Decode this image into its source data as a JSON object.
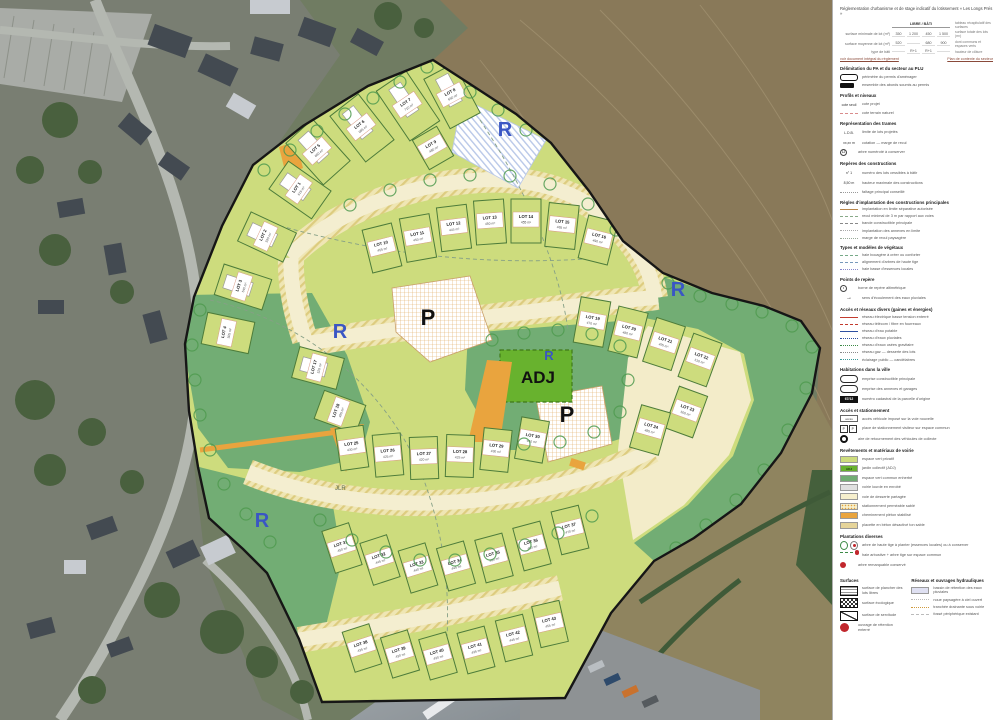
{
  "plan": {
    "labels": {
      "adj": "ADJ",
      "reserve": "R",
      "parking": "P",
      "watermark": "JLR"
    },
    "colors": {
      "lot_green": "#cddc7d",
      "lot_stroke": "#4d7c3a",
      "common_green": "#72ad74",
      "adj_green": "#68b22e",
      "road_cream": "#f4eed0",
      "road_hatch": "#e6d98f",
      "orange": "#e9a43e",
      "boundary": "#161616",
      "reserve_blue": "#3a56c4",
      "parking_grid": "#dfa95f",
      "blue_hatch": "#9db4e0"
    },
    "markers": [
      {
        "t": "R",
        "x": 505,
        "y": 136,
        "s": 20
      },
      {
        "t": "R",
        "x": 678,
        "y": 296,
        "s": 20
      },
      {
        "t": "R",
        "x": 340,
        "y": 338,
        "s": 20
      },
      {
        "t": "R",
        "x": 549,
        "y": 360,
        "s": 13
      },
      {
        "t": "R",
        "x": 262,
        "y": 527,
        "s": 20
      },
      {
        "t": "P",
        "x": 428,
        "y": 325,
        "s": 22
      },
      {
        "t": "P",
        "x": 567,
        "y": 422,
        "s": 22
      },
      {
        "t": "ADJ",
        "x": 538,
        "y": 383,
        "s": 17
      }
    ],
    "lots": [
      [
        300,
        190,
        -55,
        34,
        52,
        "LOT 1",
        "615 m²",
        1
      ],
      [
        267,
        237,
        -65,
        32,
        50,
        "LOT 2",
        "590 m²",
        1
      ],
      [
        243,
        287,
        -72,
        32,
        50,
        "LOT 3",
        "540 m²",
        1
      ],
      [
        228,
        333,
        -78,
        32,
        48,
        "LOT 4",
        "505 m²",
        0
      ],
      [
        318,
        152,
        -42,
        36,
        56,
        "LOT 5",
        "660 m²",
        1
      ],
      [
        362,
        128,
        -38,
        36,
        58,
        "LOT 6",
        "685 m²",
        1
      ],
      [
        408,
        106,
        -34,
        36,
        60,
        "LOT 7",
        "710 m²",
        1
      ],
      [
        452,
        96,
        -28,
        34,
        56,
        "LOT 8",
        "650 m²",
        1
      ],
      [
        433,
        148,
        -30,
        28,
        34,
        "LOT 9",
        "480 m²",
        0
      ],
      [
        382,
        248,
        -14,
        30,
        44,
        "LOT 10",
        "455 m²",
        0
      ],
      [
        418,
        238,
        -10,
        30,
        44,
        "LOT 11",
        "450 m²",
        0
      ],
      [
        454,
        228,
        -7,
        30,
        44,
        "LOT 12",
        "445 m²",
        0
      ],
      [
        490,
        222,
        -4,
        30,
        44,
        "LOT 13",
        "450 m²",
        0
      ],
      [
        526,
        221,
        0,
        30,
        44,
        "LOT 14",
        "455 m²",
        0
      ],
      [
        562,
        226,
        6,
        30,
        44,
        "LOT 15",
        "465 m²",
        0
      ],
      [
        598,
        240,
        14,
        30,
        44,
        "LOT 16",
        "490 m²",
        0
      ],
      [
        318,
        368,
        -75,
        32,
        46,
        "LOT 17",
        "520 m²",
        1
      ],
      [
        340,
        412,
        -70,
        30,
        44,
        "LOT 18",
        "495 m²",
        0
      ],
      [
        592,
        322,
        10,
        30,
        46,
        "LOT 19",
        "470 m²",
        0
      ],
      [
        628,
        332,
        14,
        30,
        46,
        "LOT 20",
        "480 m²",
        0
      ],
      [
        664,
        344,
        18,
        30,
        46,
        "LOT 21",
        "495 m²",
        0
      ],
      [
        700,
        360,
        20,
        30,
        46,
        "LOT 22",
        "510 m²",
        0
      ],
      [
        686,
        412,
        20,
        30,
        44,
        "LOT 23",
        "500 m²",
        0
      ],
      [
        650,
        430,
        16,
        30,
        44,
        "LOT 24",
        "485 m²",
        0
      ],
      [
        352,
        448,
        -8,
        28,
        42,
        "LOT 25",
        "430 m²",
        0
      ],
      [
        388,
        455,
        -5,
        28,
        42,
        "LOT 26",
        "425 m²",
        0
      ],
      [
        424,
        458,
        -2,
        28,
        42,
        "LOT 27",
        "420 m²",
        0
      ],
      [
        460,
        456,
        2,
        28,
        42,
        "LOT 28",
        "425 m²",
        0
      ],
      [
        496,
        450,
        6,
        28,
        42,
        "LOT 29",
        "430 m²",
        0
      ],
      [
        532,
        440,
        10,
        28,
        42,
        "LOT 30",
        "440 m²",
        0
      ],
      [
        342,
        548,
        -18,
        28,
        44,
        "LOT 31",
        "450 m²",
        0
      ],
      [
        380,
        560,
        -18,
        28,
        44,
        "LOT 32",
        "445 m²",
        0
      ],
      [
        418,
        568,
        -17,
        28,
        44,
        "LOT 33",
        "440 m²",
        0
      ],
      [
        456,
        566,
        -16,
        28,
        44,
        "LOT 34",
        "445 m²",
        0
      ],
      [
        494,
        558,
        -15,
        28,
        44,
        "LOT 35",
        "450 m²",
        0
      ],
      [
        532,
        546,
        -15,
        28,
        44,
        "LOT 36",
        "460 m²",
        0
      ],
      [
        570,
        530,
        -14,
        28,
        44,
        "LOT 37",
        "470 m²",
        0
      ],
      [
        362,
        648,
        -18,
        28,
        42,
        "LOT 38",
        "435 m²",
        0
      ],
      [
        400,
        654,
        -17,
        28,
        42,
        "LOT 39",
        "430 m²",
        0
      ],
      [
        438,
        656,
        -16,
        28,
        42,
        "LOT 40",
        "430 m²",
        0
      ],
      [
        476,
        650,
        -15,
        28,
        42,
        "LOT 41",
        "435 m²",
        0
      ],
      [
        514,
        638,
        -14,
        28,
        42,
        "LOT 42",
        "445 m²",
        0
      ],
      [
        550,
        624,
        -13,
        28,
        42,
        "LOT 43",
        "455 m²",
        0
      ]
    ]
  },
  "legend": {
    "title": "Réglementation d'urbanisme et de stage indicatif du lotissement « Les Longs Prés »",
    "table": {
      "group_header": "LIBRE / BÂTI",
      "right_header": "tableau récapitulatif des surfaces",
      "rows": [
        {
          "left": "surface minimale de lot (m²)",
          "values": [
            "350",
            "1 200",
            "450",
            "1 500"
          ],
          "right": "surface totale des lots (m²)"
        },
        {
          "left": "surface moyenne de lot (m²)",
          "values": [
            "520",
            "",
            "680",
            "900"
          ],
          "right": "dont communs et espaces verts"
        },
        {
          "left": "type de bâti",
          "values": [
            "",
            "R+1",
            "R+1",
            ""
          ],
          "right": "hauteur de clôture"
        }
      ]
    },
    "links": [
      "voir document intégral du règlement",
      "Plan de contexte du secteur"
    ],
    "sections": [
      {
        "heading": "Délimitation du PA et du secteur au PLU",
        "items": [
          {
            "icon": "rounded-outline",
            "label": "périmètre du permis d'aménager"
          },
          {
            "icon": "filled-tag",
            "label": "ensemble des abords soumis au permis"
          }
        ]
      },
      {
        "heading": "Profils et niveaux",
        "items": [
          {
            "icon": "text-code",
            "code": "cote seuil",
            "label": "cote projet"
          },
          {
            "icon": "line",
            "color": "#d98c8c",
            "style": "dashed",
            "label": "cote terrain naturel"
          }
        ]
      },
      {
        "heading": "Représentation des trames",
        "items": [
          {
            "icon": "text-code",
            "code": "L.D.B.",
            "label": "limite de lots projetés"
          },
          {
            "icon": "text-code",
            "code": "xx,xx m",
            "label": "cotation — marge de recul"
          },
          {
            "icon": "circled",
            "code": "12",
            "label": "arbre numéroté à conserver"
          }
        ]
      },
      {
        "heading": "Repères des constructions",
        "items": [
          {
            "icon": "text-code",
            "code": "n° 1",
            "label": "numéro des lots cessibles à bâtir"
          },
          {
            "icon": "text-code",
            "code": "8,50 m",
            "label": "hauteur maximale des constructions"
          },
          {
            "icon": "line",
            "color": "#999999",
            "style": "dotted",
            "label": "faîtage principal conseillé"
          }
        ]
      },
      {
        "heading": "Règles d'implantation des constructions principales",
        "items": [
          {
            "icon": "line",
            "color": "#b8864a",
            "style": "solid",
            "label": "implantation en limite séparative autorisée"
          },
          {
            "icon": "line",
            "color": "#88aa88",
            "style": "dashed",
            "label": "recul minimal de 3 m par rapport aux voies"
          },
          {
            "icon": "line",
            "color": "#888888",
            "style": "dashed",
            "label": "bande constructible principale"
          },
          {
            "icon": "line",
            "color": "#aaaaaa",
            "style": "dotted",
            "label": "implantation des annexes en limite"
          },
          {
            "icon": "line",
            "color": "#99aa99",
            "style": "dotted",
            "label": "marge de recul paysagère"
          }
        ]
      },
      {
        "heading": "Types et modèles de végétaux",
        "items": [
          {
            "icon": "line",
            "color": "#77aa88",
            "style": "dashed",
            "label": "haie bocagère à créer ou conforter"
          },
          {
            "icon": "line",
            "color": "#7799bb",
            "style": "dashed",
            "label": "alignement d'arbres de haute tige"
          },
          {
            "icon": "line",
            "color": "#8888cc",
            "style": "dotted",
            "label": "haie basse d'essences locales"
          }
        ]
      },
      {
        "heading": "Points de repère",
        "items": [
          {
            "icon": "circled",
            "code": "•",
            "label": "borne de repère altimétrique"
          },
          {
            "icon": "arrow",
            "code": "→",
            "label": "sens d'écoulement des eaux pluviales"
          }
        ]
      },
      {
        "heading": "Accès et réseaux divers (gaines et énergies)",
        "items": [
          {
            "icon": "dashline",
            "color": "#c23b2e",
            "style": "solid",
            "label": "réseau électrique basse tension enterré"
          },
          {
            "icon": "dashline",
            "color": "#c23b2e",
            "style": "dashed",
            "label": "réseau télécom / fibre en fourreaux"
          },
          {
            "icon": "dashline",
            "color": "#2d4fa1",
            "style": "solid",
            "label": "réseau d'eau potable"
          },
          {
            "icon": "dashline",
            "color": "#2d4fa1",
            "style": "dotted",
            "label": "réseau d'eaux pluviales"
          },
          {
            "icon": "dashline",
            "color": "#3c8a46",
            "style": "dotted",
            "label": "réseau d'eaux usées gravitaire"
          },
          {
            "icon": "dashline",
            "color": "#8a8a8a",
            "style": "dotted",
            "label": "réseau gaz — desserte des lots"
          },
          {
            "icon": "dashline",
            "color": "#3a9a9a",
            "style": "dotted",
            "label": "éclairage public — candélabres"
          }
        ]
      },
      {
        "heading": "Habitations dans la ville",
        "items": [
          {
            "icon": "white-rounded",
            "label": "emprise constructible principale"
          },
          {
            "icon": "white-rounded",
            "label": "emprise des annexes et garages"
          },
          {
            "icon": "black-box",
            "code": "67/12",
            "label": "numéro cadastral de la parcelle d'origine"
          }
        ]
      },
      {
        "heading": "Accès et stationnement",
        "items": [
          {
            "icon": "white-box",
            "code": "accès",
            "label": "accès véhicule imposé sur la voie nouvelle"
          },
          {
            "icon": "letter-boxes",
            "code": "P P",
            "label": "place de stationnement visiteur sur espace commun"
          },
          {
            "icon": "wheel",
            "label": "aire de retournement des véhicules de collecte"
          }
        ]
      },
      {
        "heading": "Revêtements et matériaux de voirie",
        "items": [
          {
            "icon": "swatch",
            "color": "#cddc7d",
            "label": "espace vert privatif"
          },
          {
            "icon": "swatch",
            "color": "#68b22e",
            "code": "ADJ",
            "label": "jardin collectif (ADJ)"
          },
          {
            "icon": "swatch",
            "color": "#72ad74",
            "label": "espace vert commun enherbé"
          },
          {
            "icon": "swatch",
            "color": "#e0e0e0",
            "label": "voirie lourde en enrobé"
          },
          {
            "icon": "swatch",
            "color": "#f6efcd",
            "label": "voie de desserte partagée"
          },
          {
            "icon": "swatch-dots",
            "color": "#f6efcd",
            "dot": "#e2a23c",
            "label": "stationnement perméable sablé"
          },
          {
            "icon": "swatch",
            "color": "#e9a43e",
            "label": "cheminement piéton stabilisé"
          },
          {
            "icon": "swatch",
            "color": "#e5d49a",
            "label": "placette en béton désactivé ton sable"
          }
        ]
      },
      {
        "heading": "Plantations diverses",
        "items": [
          {
            "icon": "two-circles",
            "label": "arbre de haute tige à planter (essences locales) ou à conserver"
          },
          {
            "icon": "greendash-reddot",
            "label": "haie arbustive + arbre tige sur espace commun"
          },
          {
            "icon": "red-dot",
            "label": "arbre remarquable conservé"
          }
        ]
      }
    ],
    "footer": {
      "left": {
        "heading": "Surfaces",
        "items": [
          {
            "icon": "box-lines",
            "label": "surface de plancher des lots libres"
          },
          {
            "icon": "box-checker",
            "label": "surface écologique"
          },
          {
            "icon": "box-diag",
            "label": "surface de servitude"
          },
          {
            "icon": "red-dot-big",
            "label": "ouvrage de rétention enterré"
          }
        ]
      },
      "right": {
        "heading": "Réseaux et ouvrages hydrauliques",
        "items": [
          {
            "icon": "swatch",
            "color": "#dfe0f2",
            "label": "bassin de rétention des eaux pluviales"
          },
          {
            "icon": "line",
            "color": "#bbbbbb",
            "style": "dotted",
            "label": "noue paysagère à ciel ouvert"
          },
          {
            "icon": "line",
            "color": "#d09a3e",
            "style": "dotted",
            "label": "tranchée drainante sous voirie"
          },
          {
            "icon": "line",
            "color": "#bbbbbb",
            "style": "dashed",
            "label": "fossé périphérique existant"
          }
        ]
      }
    }
  }
}
